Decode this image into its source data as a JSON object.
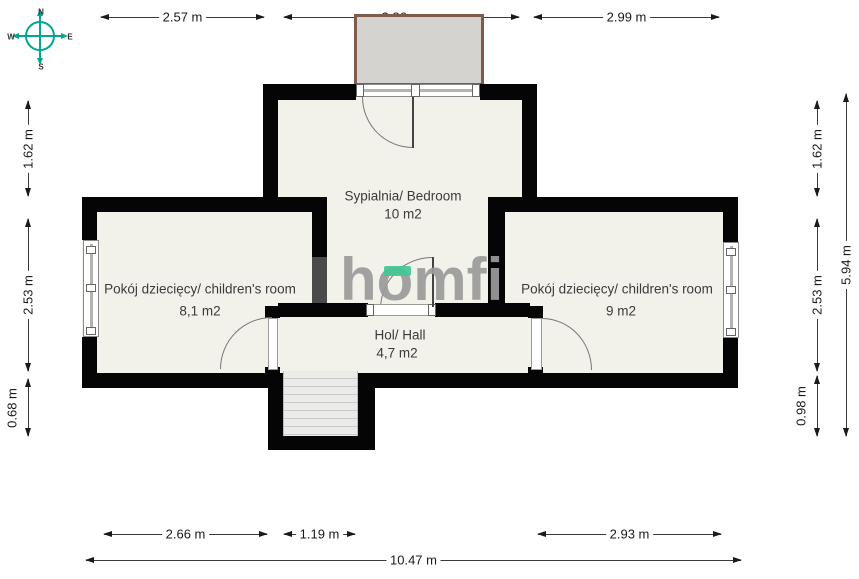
{
  "compass": {
    "n": "N",
    "e": "E",
    "s": "S",
    "w": "W"
  },
  "watermark": {
    "text": "homfi"
  },
  "rooms": {
    "bedroom": {
      "name": "Sypialnia/ Bedroom",
      "area": "10 m2"
    },
    "child_left": {
      "name": "Pokój dziecięcy/ children's room",
      "area": "8,1 m2"
    },
    "child_right": {
      "name": "Pokój dziecięcy/ children's room",
      "area": "9 m2"
    },
    "hall": {
      "name": "Hol/ Hall",
      "area": "4,7 m2"
    }
  },
  "dimensions": {
    "top": [
      "2.57 m",
      "3.86 m",
      "2.99 m"
    ],
    "left": [
      "1.62 m",
      "2.53 m",
      "0.68 m"
    ],
    "right": [
      "1.62 m",
      "2.53 m",
      "0.98 m"
    ],
    "right_total": "5.94 m",
    "bottom": [
      "2.66 m",
      "1.19 m",
      "2.93 m"
    ],
    "bottom_total": "10.47 m"
  },
  "colors": {
    "wall": "#050505",
    "floor": "#f2f1ea",
    "balcony_fill": "#d4d3cf",
    "balcony_border": "#7e5c49",
    "stairs_fill": "#ebebe9",
    "compass_teal": "#00a68f",
    "watermark_gray": "#9b9b9b",
    "watermark_green": "#40c694",
    "dimension_text": "#1a1a1a"
  }
}
